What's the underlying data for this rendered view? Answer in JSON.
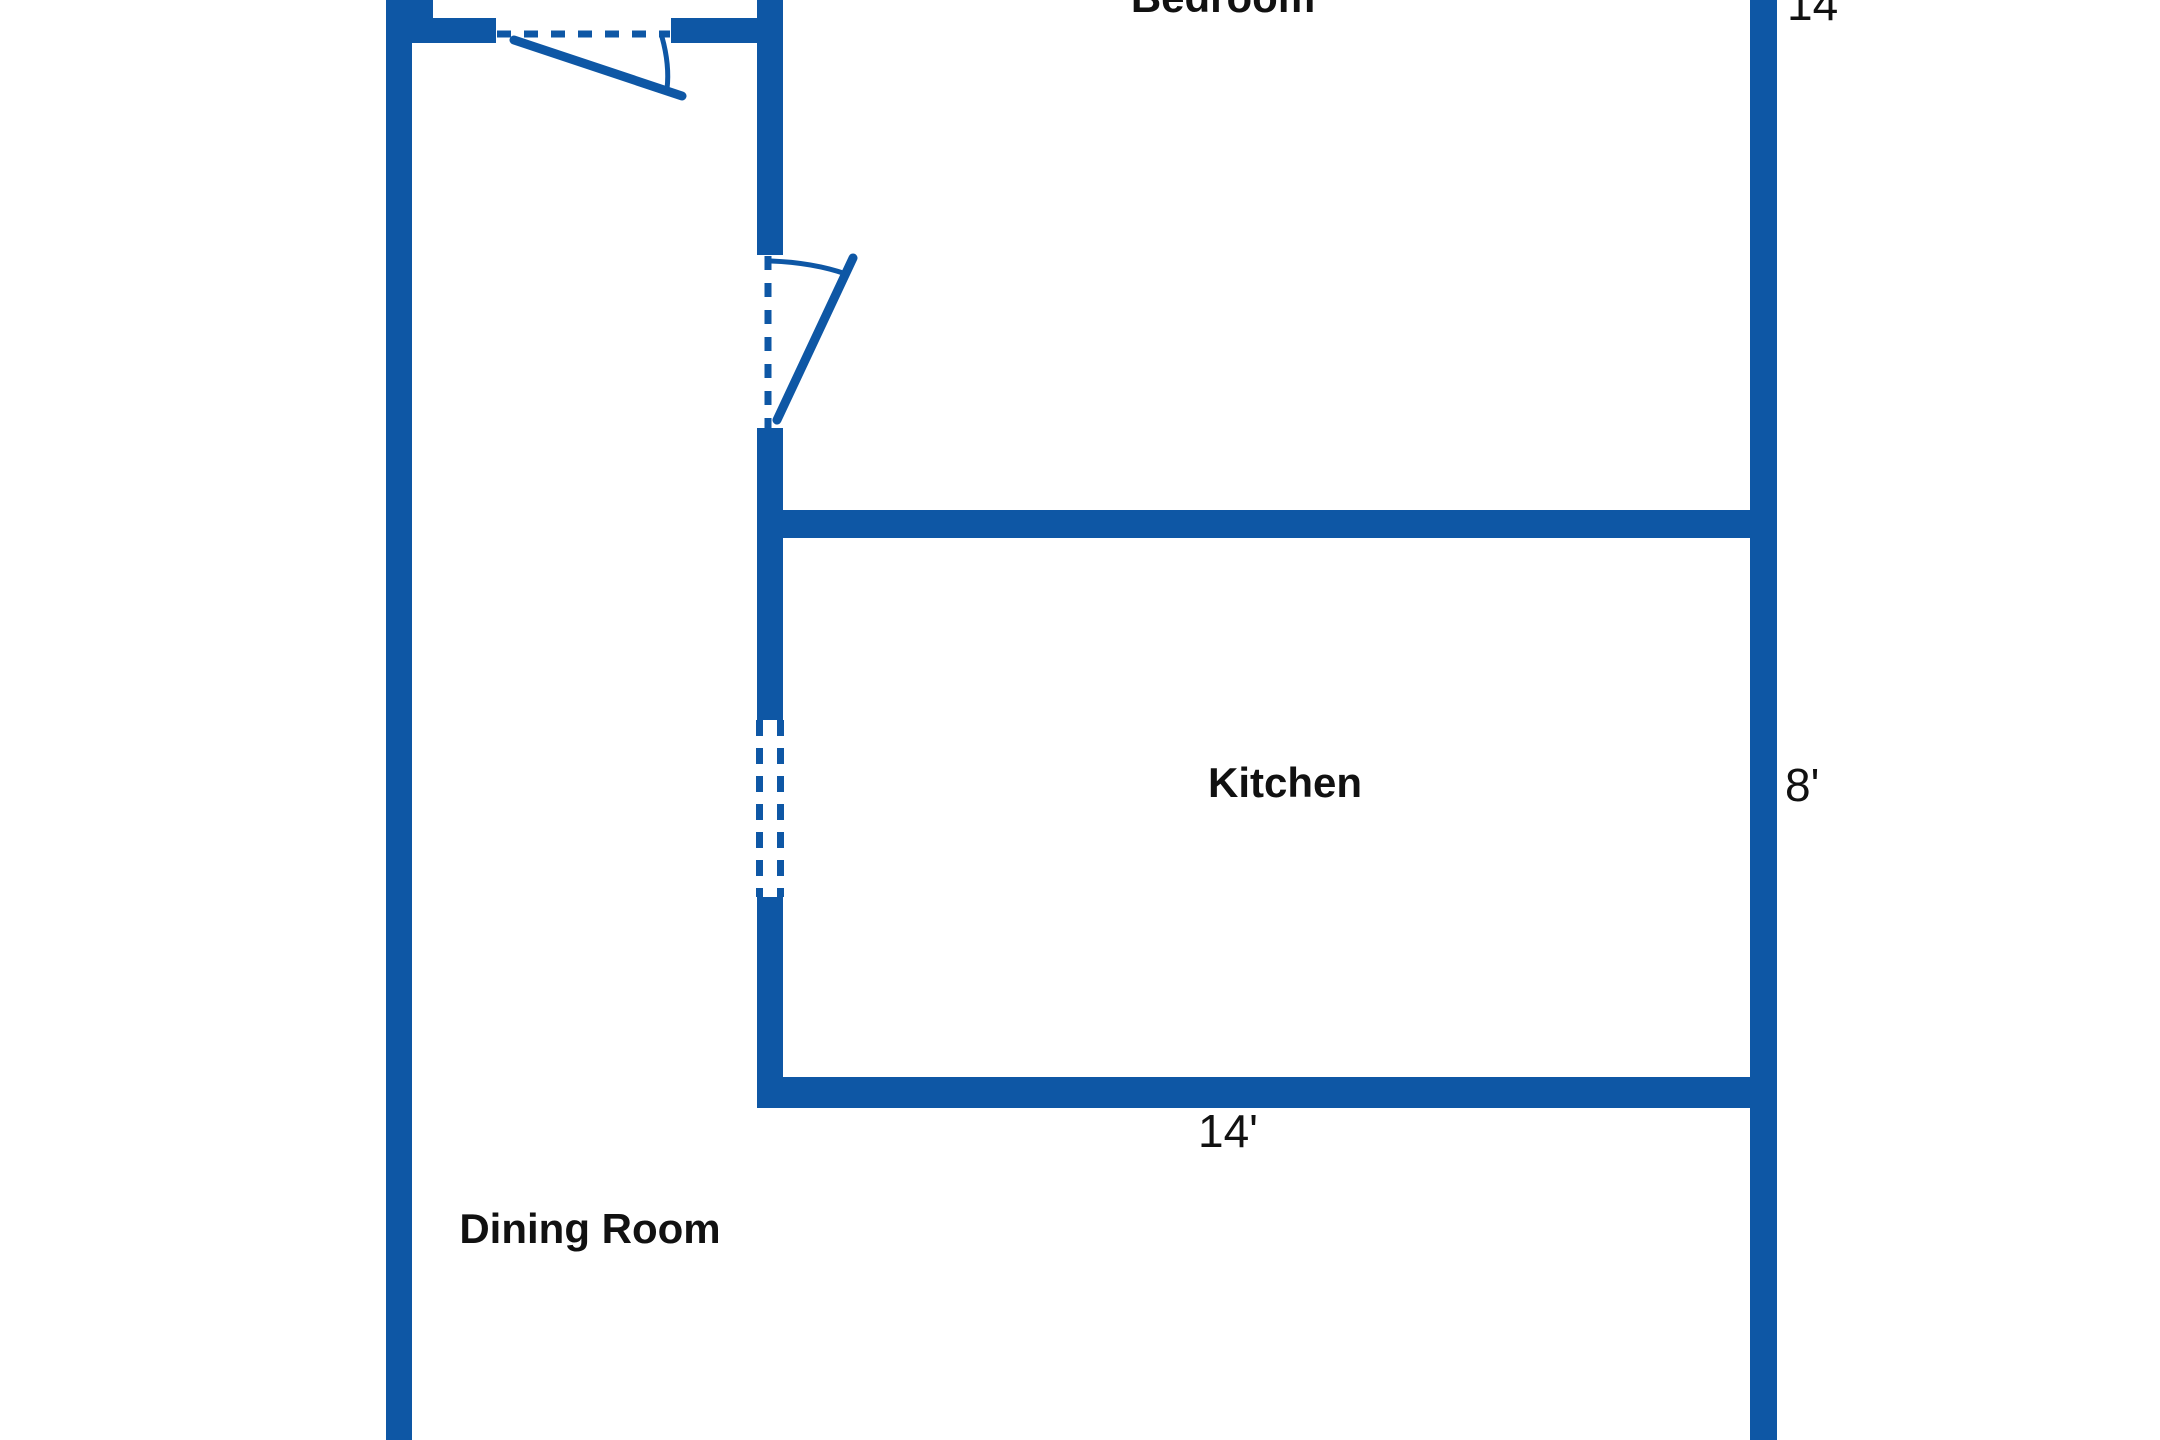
{
  "colors": {
    "wall": "#0e57a5",
    "label": "#111111",
    "background": "#ffffff"
  },
  "rooms": {
    "bedroom": {
      "label": "Bedroom"
    },
    "kitchen": {
      "label": "Kitchen"
    },
    "dining_room": {
      "label": "Dining Room"
    }
  },
  "dimensions": {
    "bedroom_side": {
      "label": "14'"
    },
    "kitchen_side": {
      "label": "8'"
    },
    "kitchen_width": {
      "label": "14'"
    }
  }
}
